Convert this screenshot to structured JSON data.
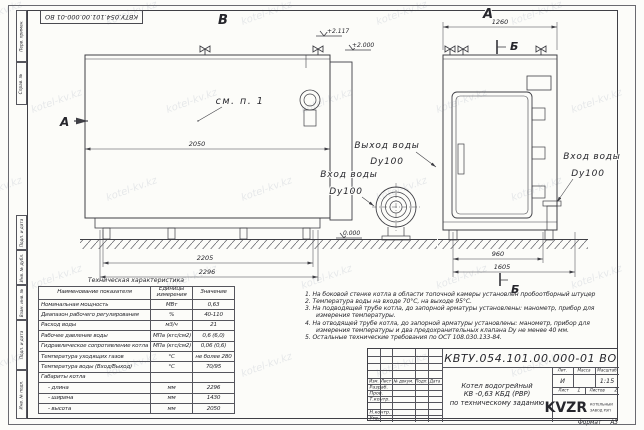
{
  "watermark": "kotel-kv.kz",
  "sheet": {
    "top_stamp": "КВТУ.054.101.00.000-01 ВО",
    "margin_labels": [
      "Перв. примен.",
      "Справ. №",
      "Подп. и дата",
      "Инв. № дубл.",
      "Взам. инв. №",
      "Подп. и дата",
      "Инв. № подл."
    ],
    "format_label": "Формат",
    "format_value": "А3"
  },
  "drawing": {
    "view_b": {
      "label": "В",
      "section_a": "А",
      "see_note": "см. п. 1",
      "elev_top": "+2.117",
      "elev_mid": "+2.000",
      "elev_zero": "0.000",
      "dim_mid": "2050",
      "dim_base": "2205",
      "dim_overall": "2296",
      "outlet_line1": "Выход воды",
      "outlet_line2": "Dy100",
      "inlet_line1": "Вход воды",
      "inlet_line2": "Dy100"
    },
    "view_a": {
      "label": "А",
      "section_b_top": "Б",
      "section_b_bottom": "Б",
      "dim_top": "1260",
      "dim_base": "960",
      "dim_overall": "1605",
      "inlet_line1": "Вход воды",
      "inlet_line2": "Dy100"
    }
  },
  "spec_table": {
    "title": "Техническая характеристика",
    "col1": "Наименование показателя",
    "col2": "Единицы измерения",
    "col3": "Значение",
    "rows": [
      [
        "Номинальная мощность",
        "МВт",
        "0,63"
      ],
      [
        "Диапазон рабочего регулирования",
        "%",
        "40-110"
      ],
      [
        "Расход воды",
        "м3/ч",
        "21"
      ],
      [
        "Рабочее давление воды",
        "МПа (кгс/см2)",
        "0,6 (6,0)"
      ],
      [
        "Гидравлическое сопротивление котла",
        "МПа (кгс/см2)",
        "0,06 (0,6)"
      ],
      [
        "Температура уходящих газов",
        "°С",
        "не более 280"
      ],
      [
        "Температура воды (Вход/Выход)",
        "°С",
        "70/95"
      ],
      [
        "Габариты котла",
        "",
        ""
      ],
      [
        "- длина",
        "мм",
        "2296"
      ],
      [
        "- ширина",
        "мм",
        "1430"
      ],
      [
        "- высота",
        "мм",
        "2050"
      ]
    ]
  },
  "notes": [
    "1.  На боковой стенке котла в области топочной камеры установлен пробоотборный штуцер",
    "2.  Температура воды на входе 70°С, на выходе 95°С.",
    "3.  На подводящей трубе котла, до запорной арматуры установлены: манометр, прибор для измерения температуры.",
    "4.  На отводящей трубе котла, до запорной арматуры установлены: манометр, прибор для измерения температуры и два предохранительных клапана Dу не менее 40 мм.",
    "5.  Остальные технические требования по ОСТ 108.030.133-84."
  ],
  "title_block": {
    "doc_number": "КВТУ.054.101.00.000-01 ВО",
    "product_line1": "Котел водогрейный",
    "product_line2": "КВ -0,63 КБД (РВР)",
    "product_line3": "по техническому заданию",
    "cols": [
      "Изм.",
      "Лист",
      "№ докум.",
      "Подп.",
      "Дата"
    ],
    "roles": [
      "Разраб.",
      "Пров.",
      "Т.контр.",
      "",
      "Н.контр.",
      "Утв."
    ],
    "lit_label": "Лит.",
    "mass_label": "Масса",
    "scale_label": "Масштаб",
    "lit_value": "И",
    "mass_value": "",
    "scale_value": "1:15",
    "sheet_label": "Лист",
    "sheet_value": "1",
    "sheets_label": "Листов",
    "sheets_value": "2",
    "logo_text": "KVZR",
    "logo_sub1": "КОТЕЛЬНЫЙ",
    "logo_sub2": "ЗАВОД РЭП"
  }
}
